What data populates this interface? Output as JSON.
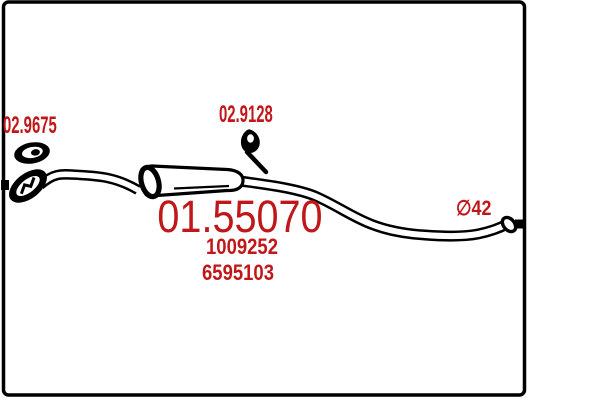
{
  "colors": {
    "ink": "#000000",
    "label": "#c0181a",
    "background": "#ffffff"
  },
  "diagram": {
    "labels": {
      "gasket_part_number": "02.9675",
      "hanger_part_number": "02.9128",
      "main_part_number": "01.55070",
      "oe_reference_1": "1009252",
      "oe_reference_2": "6595103",
      "pipe_diameter": "∅42"
    },
    "icons": {
      "gasket": "oval-gasket-icon",
      "flange": "exhaust-flange-icon",
      "hanger": "rubber-hanger-icon",
      "muffler": "middle-silencer-body",
      "front_pipe": "front-pipe",
      "tail_pipe": "tail-pipe"
    }
  }
}
